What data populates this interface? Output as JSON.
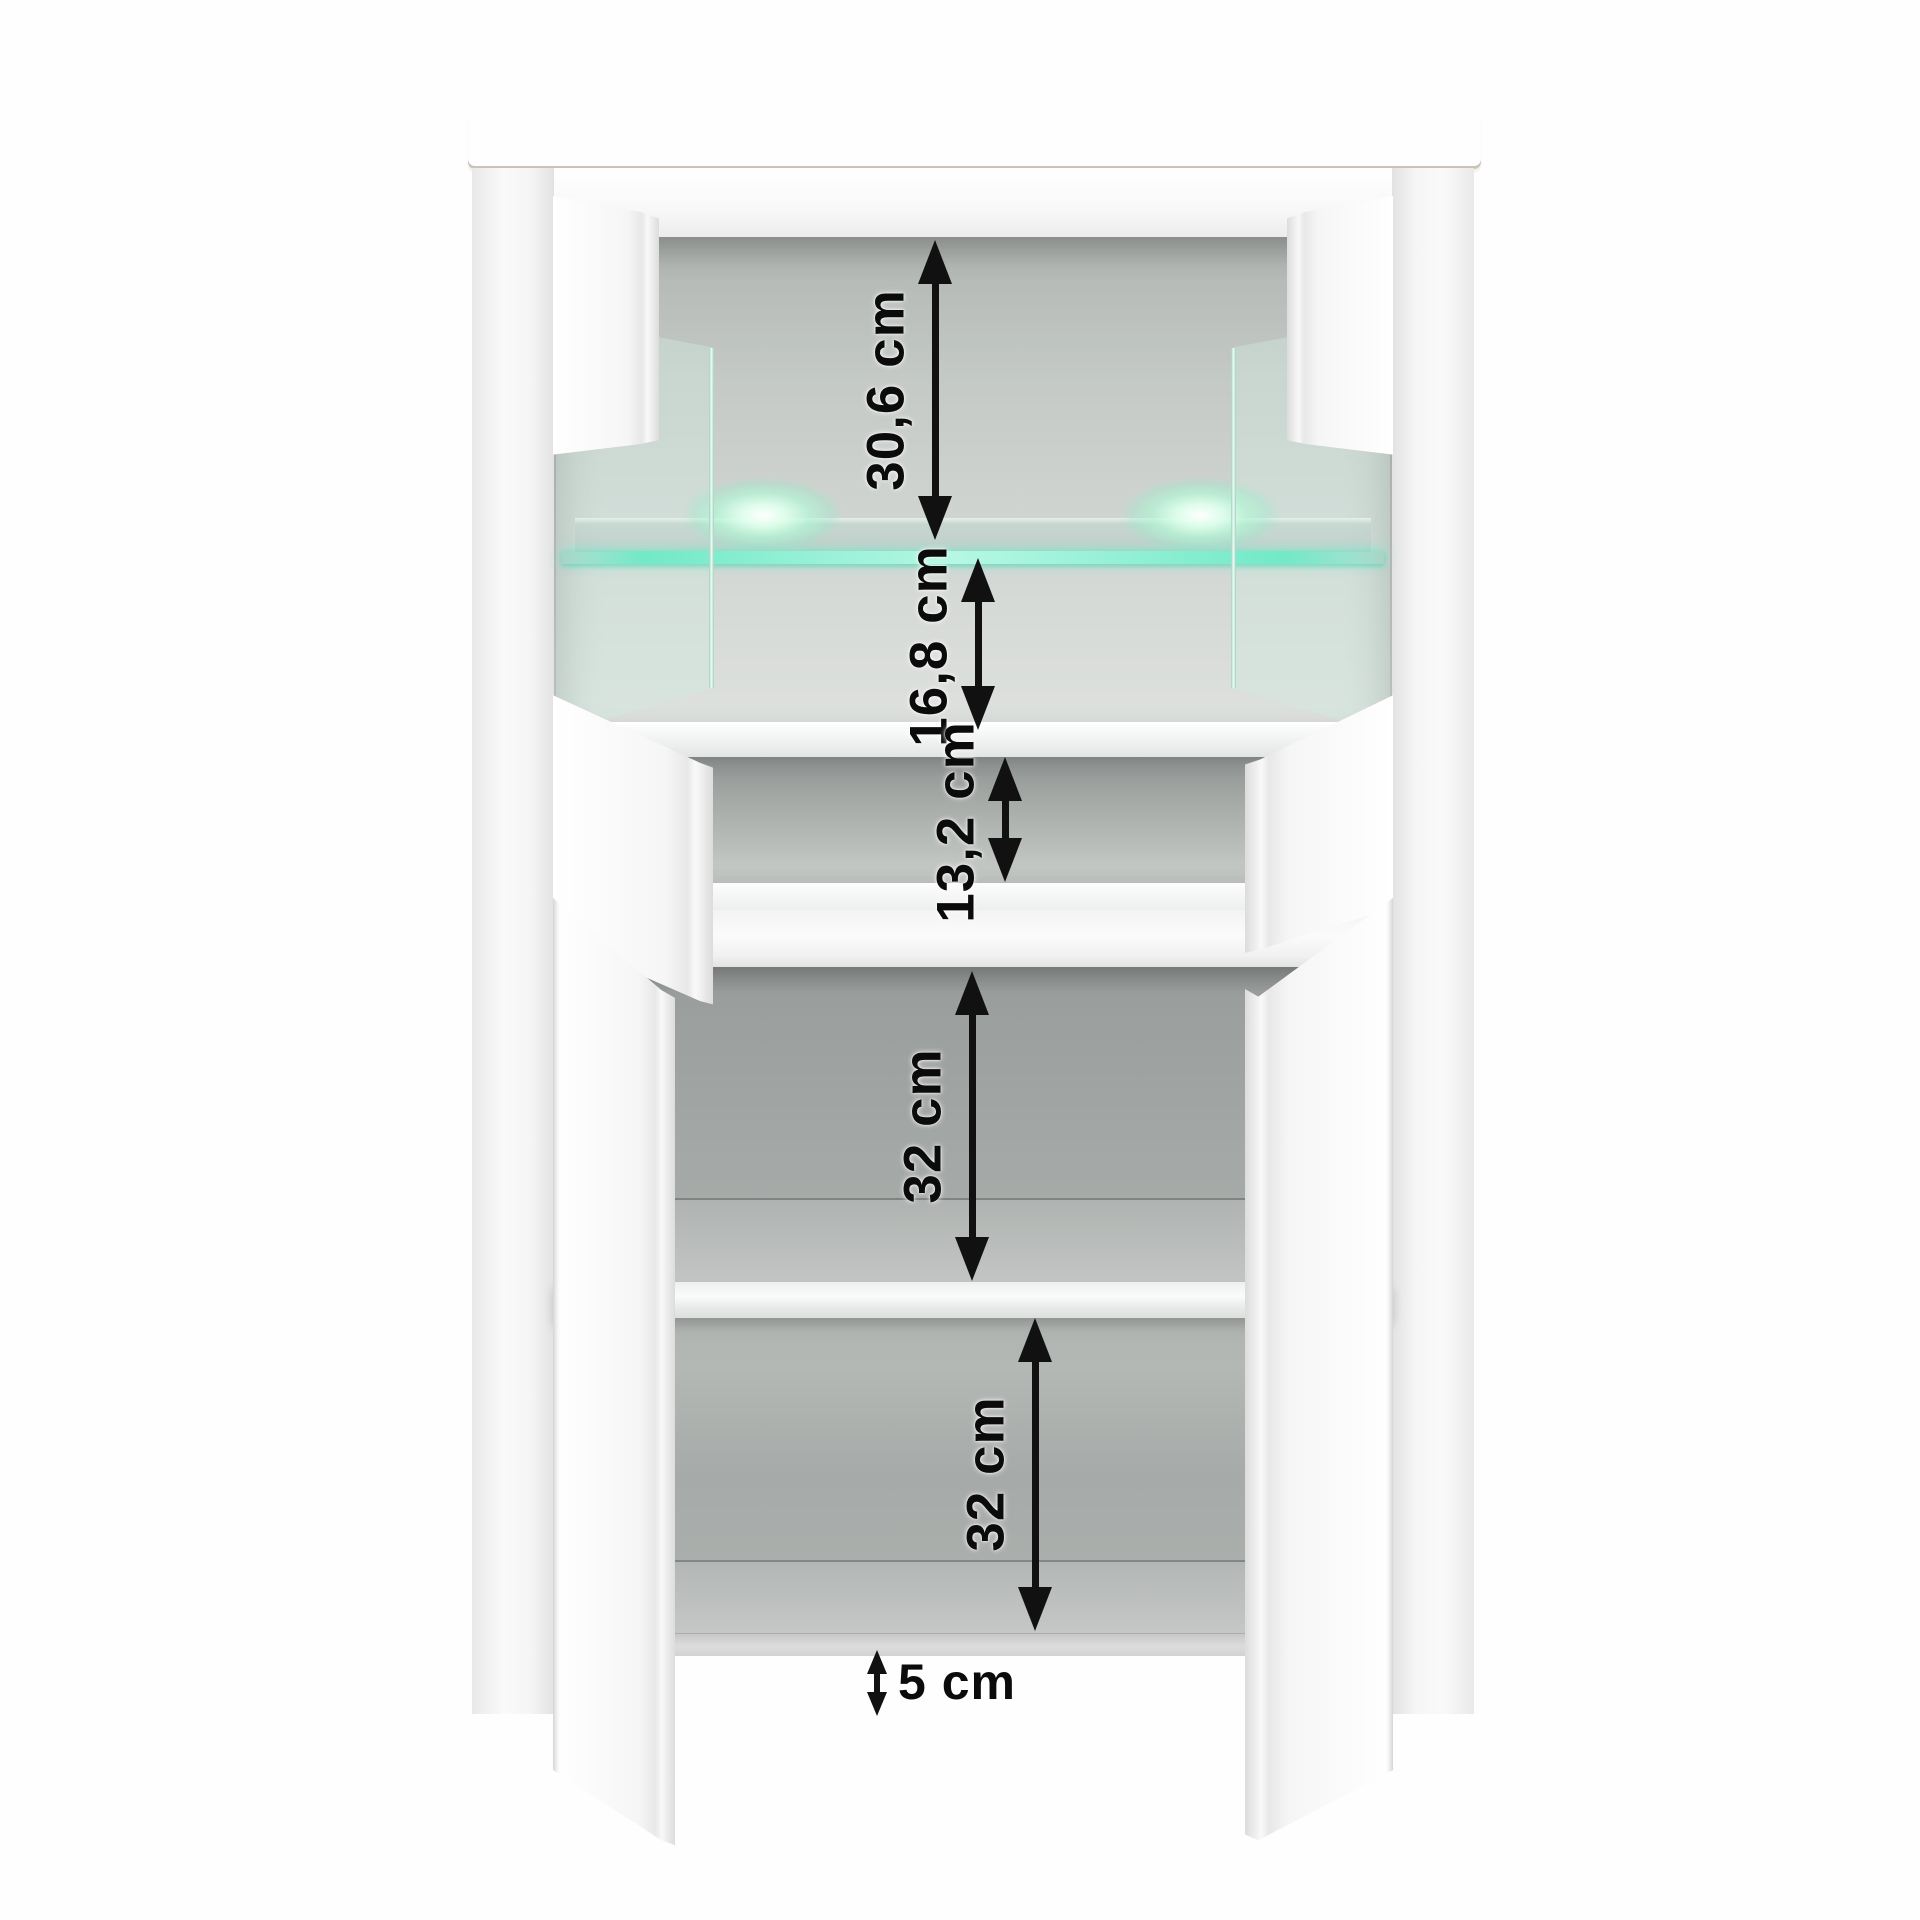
{
  "diagram": {
    "type": "furniture-dimension-diagram",
    "subject": "display cabinet with LED glass vitrine, open doors, oak top",
    "unit": "cm"
  },
  "colors": {
    "wood_top": "#c49a60",
    "body_white": "#fafafa",
    "interior_gray": "#a9ada9",
    "led_glow": "#8df0d2",
    "glass_tint": "#d1eadf",
    "arrow": "#111111"
  },
  "dimensions": [
    {
      "id": "vitrine-upper-compartment-height",
      "label": "30,6 cm"
    },
    {
      "id": "vitrine-lower-compartment-height",
      "label": "16,8 cm"
    },
    {
      "id": "open-compartment-height",
      "label": "13,2 cm"
    },
    {
      "id": "lower-compartment-top-height",
      "label": "32 cm"
    },
    {
      "id": "lower-compartment-bottom-height",
      "label": "32 cm"
    },
    {
      "id": "plinth-gap-height",
      "label": "5 cm"
    }
  ]
}
